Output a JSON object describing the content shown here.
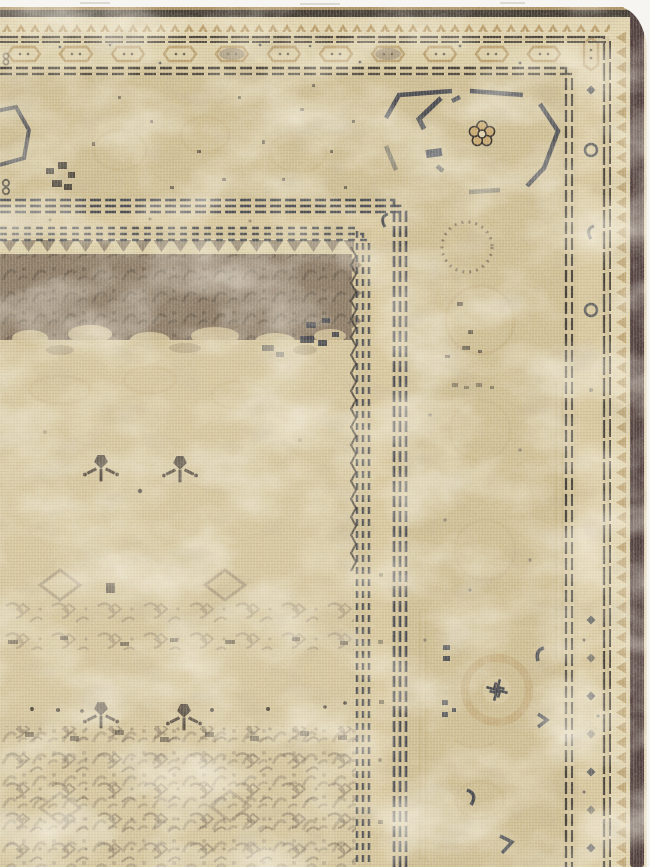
{
  "image": {
    "description": "Corner detail photograph of an antique hand-knotted rug: faded beige field with sparse flower sprigs, a worn dark-taupe top panel, layered guard and minor borders, a wide main border with octagon medallions and rosettes, and a dark selvage edge on the right",
    "subject": "worn antique rug corner",
    "orientation": "top and right borders visible, field at lower left"
  },
  "palette": {
    "white": "#f6f5f1",
    "base": "#d3c398",
    "field": "#d6c79e",
    "cream": "#e1d4ae",
    "cream2": "#dccfa6",
    "minor": "#d8c89d",
    "beige": "#cfbf93",
    "tan": "#b3945f",
    "tanline": "#a98e60",
    "ghost": "#bfa270",
    "pend": "#8a7b66",
    "panel": "#8c7b65",
    "curl": "#5f5344",
    "herati": "#8d7d67",
    "sprig": "#544a3c",
    "ink": "#342f28",
    "navy": "#2e3340",
    "dark2": "#4a4239",
    "selvage": "#4e3d3a",
    "pale": "#e8dec3",
    "grayline": "#c9c6bd"
  },
  "motifs": {
    "main_border": "open octagon medallions with small wheel rosettes",
    "minor_border_top": "row of scalloped cartouches with dark dots",
    "edge_band": "reciprocal arrowhead / sawtooth row",
    "guards": "triple dashed dark lines turning the corner",
    "field": "faded herati pattern with paired flower sprigs and diamond outlines",
    "field_panel": "dense worn dark-taupe floral panel with pendant triangles",
    "right_medallion": "soft tan octofoil ring with dark pinwheel center"
  },
  "regions": {
    "top_border": "horizontal band stack along top edge",
    "right_border": "vertical band stack along right edge",
    "field": "large faded beige area, lower left",
    "selvage": "dark maroon-brown woven edge, far right",
    "background": "white photo background at top and right slivers"
  }
}
